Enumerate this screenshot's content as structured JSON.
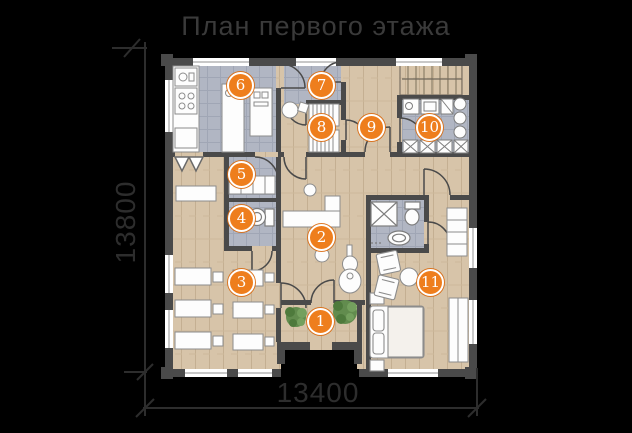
{
  "title": "План первого этажа",
  "dimensions": {
    "width_label": "13400",
    "height_label": "13800"
  },
  "rooms": [
    {
      "number": "1"
    },
    {
      "number": "2"
    },
    {
      "number": "3"
    },
    {
      "number": "4"
    },
    {
      "number": "5"
    },
    {
      "number": "6"
    },
    {
      "number": "7"
    },
    {
      "number": "8"
    },
    {
      "number": "9"
    },
    {
      "number": "10"
    },
    {
      "number": "11"
    }
  ],
  "colors": {
    "background": "#000000",
    "accent_orange": "#ee7e1d",
    "wall": "#4a4a4a",
    "wood_floor": "#d7c4a9",
    "tile_floor": "#b1b6c3",
    "dimension_text": "#2d2d2d",
    "title_text": "#3a3a3a",
    "plant_green": "#628c4e"
  },
  "icons": [
    "stove-icon",
    "sink-icon",
    "toilet-icon",
    "shower-icon",
    "washer-icon",
    "bed-icon",
    "guitar-icon",
    "plant-icon",
    "stairs-icon",
    "wardrobe-icon",
    "desk-icon"
  ]
}
